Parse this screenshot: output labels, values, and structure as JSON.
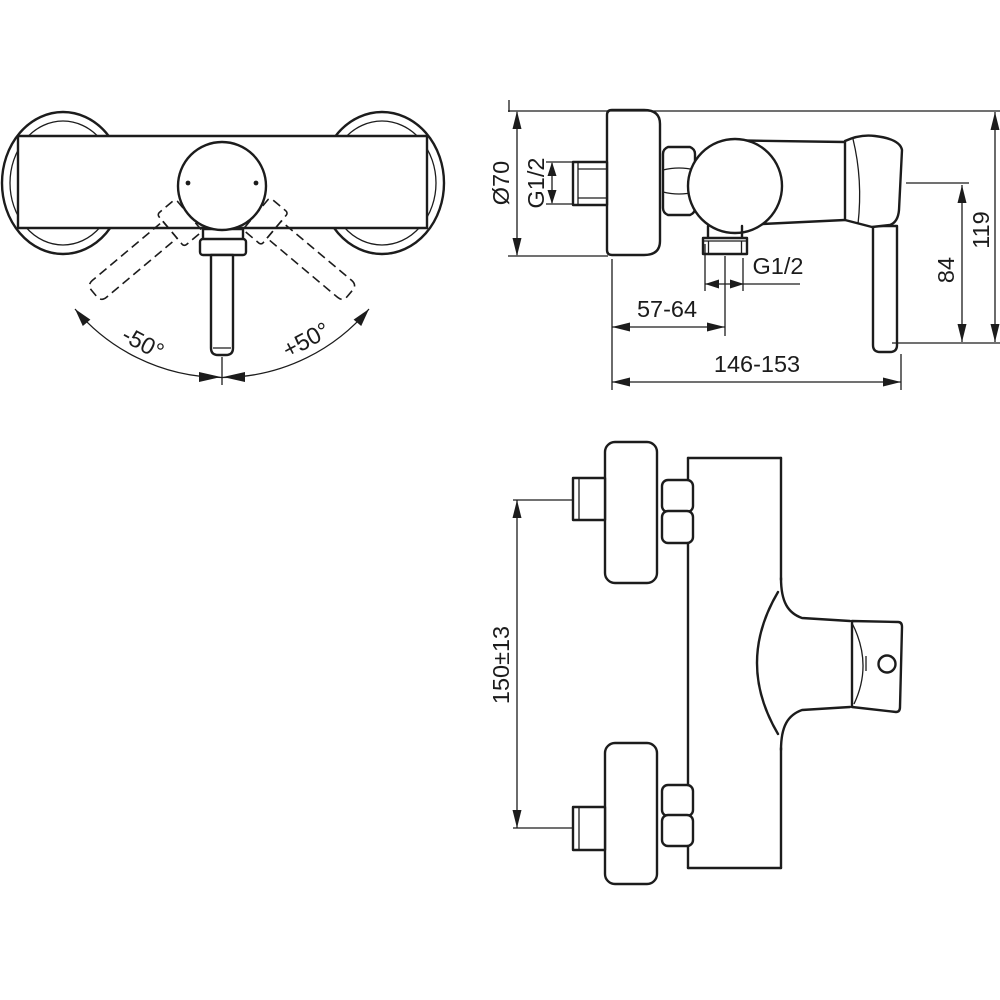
{
  "front_view": {
    "angle_left_label": "-50°",
    "angle_right_label": "+50°"
  },
  "side_view": {
    "rosette_diameter_label": "Ø70",
    "inlet_thread_label": "G1/2",
    "outlet_thread_label": "G1/2",
    "outlet_offset_label": "57-64",
    "overall_depth_label": "146-153",
    "handle_drop_label": "84",
    "overall_height_label": "119"
  },
  "plan_view": {
    "inlet_spacing_label": "150±13"
  },
  "style": {
    "line_color": "#1c1c1c",
    "background_color": "#ffffff"
  }
}
